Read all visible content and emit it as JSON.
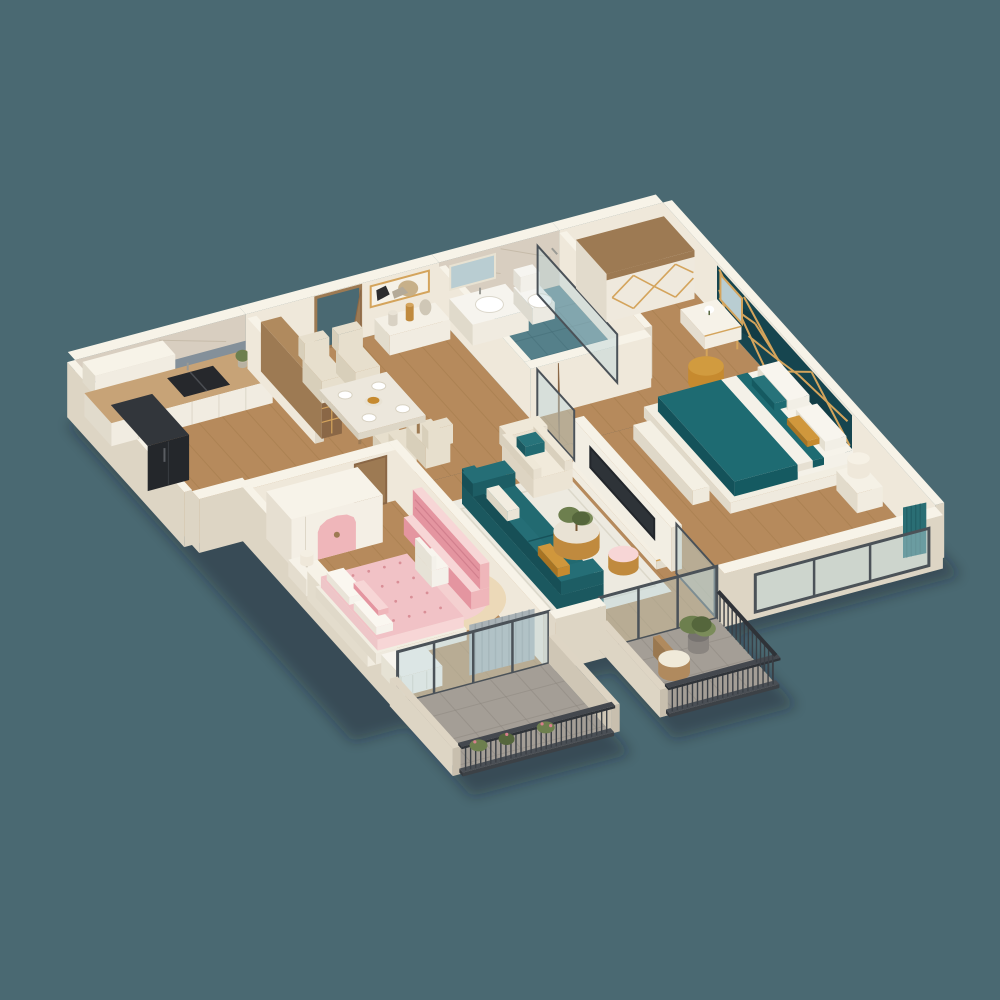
{
  "scene": {
    "name": "3d-apartment-dollhouse-floorplan",
    "background": "#4a6972",
    "canvas": {
      "width": 1000,
      "height": 1000
    }
  },
  "palette": {
    "bg": "#4a6972",
    "shadow": "rgba(18,32,38,0.38)",
    "wallCream": "#efe8da",
    "wallCreamDark": "#e0d8c8",
    "wallTop": "#f7f3e8",
    "wallOuter": "#ddd5c4",
    "marbleBeige": "#d8cec0",
    "marbleVein": "#bfb3a0",
    "marbleGray": "#84909a",
    "woodFloor": "#b68a5c",
    "woodPlank": "#96713f",
    "balconyTile": "#a49e96",
    "balconyTileDark": "#8b857d",
    "bathFloor": "#55808a",
    "bathGrout": "#47707a",
    "cabinetWhite": "#f1ece1",
    "cabinetShade": "#e1dbcc",
    "counterTop": "#c7a377",
    "sinkBlack": "#26282c",
    "fridge": "#24272b",
    "fridgeSide": "#32363b",
    "woodDark": "#8a6746",
    "woodMid": "#9d7a53",
    "woodLight": "#b08a5e",
    "gold": "#c08a3e",
    "goldLight": "#d4a45c",
    "tableTop": "#ece7dc",
    "chairCream": "#e7dfcd",
    "chairShade": "#d8cfba",
    "sofaTeal": "#226a71",
    "sofaTealDark": "#1b585f",
    "rugWhite": "#edeae0",
    "tvScreen": "#2e3338",
    "tealWall": "#16454f",
    "tealWallDark": "#0f3139",
    "bedWhite": "#f4f1e9",
    "bedTeal": "#1e6b72",
    "bedTealDark": "#155a61",
    "mustard": "#c68a2f",
    "pinkMain": "#efb6ba",
    "pinkLight": "#f7d6d6",
    "pinkDark": "#e495a0",
    "pinkBed": "#f1c2c6",
    "rugPink": "#f4d0d0",
    "rugCreamRing": "#ecd9b8",
    "curtainGray": "#a9b2b6",
    "curtainTeal": "#2a6e74",
    "railing": "#3a3f45",
    "railingDark": "#2b2f34",
    "glass": "rgba(186,212,218,0.45)",
    "glassFrame": "#4b5258",
    "plant": "#6d7f4e",
    "plantDark": "#55663c",
    "toiletWhite": "#f6f5f1",
    "mirror": "#b9cdd2"
  },
  "rooms": [
    {
      "id": "kitchen",
      "label": "Kitchen",
      "furniture": [
        "marble-feature-wall",
        "white-cabinets",
        "marble-countertop",
        "double-sink",
        "refrigerator"
      ]
    },
    {
      "id": "dining-entry",
      "label": "Dining & Entry",
      "furniture": [
        "entry-door",
        "display-cabinet",
        "dining-table",
        "dining-chairs",
        "console-table",
        "wall-art",
        "vases"
      ]
    },
    {
      "id": "bathroom",
      "label": "Bathroom",
      "furniture": [
        "vanity-sink",
        "mirror",
        "toilet",
        "walk-in-shower"
      ]
    },
    {
      "id": "master-bedroom",
      "label": "Master Bedroom",
      "furniture": [
        "teal-geometric-accent-wall",
        "wardrobe",
        "dressing-table",
        "vanity-mirror",
        "gold-pouf",
        "double-bed",
        "bed-bench",
        "nightstand",
        "table-lamp",
        "window-curtains"
      ]
    },
    {
      "id": "living-room",
      "label": "Living Room",
      "furniture": [
        "teal-sofa",
        "cream-armchair",
        "area-rug",
        "gold-coffee-tables",
        "tv-media-wall",
        "television",
        "balcony-glass-doors"
      ]
    },
    {
      "id": "kids-bedroom",
      "label": "Kids Bedroom",
      "furniture": [
        "arch-wardrobe",
        "pink-bed",
        "round-rug",
        "pink-desk-shelf",
        "desk-chair",
        "nightstand-lamp",
        "gray-curtains",
        "storage-bench"
      ]
    },
    {
      "id": "kids-balcony",
      "label": "Balcony 1",
      "furniture": [
        "metal-railing",
        "flower-boxes"
      ]
    },
    {
      "id": "living-balcony",
      "label": "Balcony 2",
      "furniture": [
        "metal-railing",
        "rattan-chair",
        "potted-plant"
      ]
    }
  ]
}
